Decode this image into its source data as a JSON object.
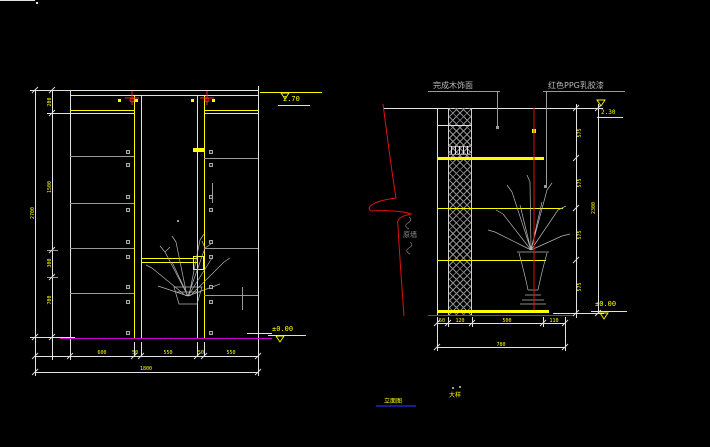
{
  "colors": {
    "line_yellow": "#ffff00",
    "line_white": "#e2e2e2",
    "line_gray": "#9a9a9a",
    "line_red": "#ff1a1a",
    "floor_magenta": "#cc00cc",
    "underline_navy": "#1b1b8f"
  },
  "left_view": {
    "elev_top": "2.70",
    "elev_floor": "±0.00",
    "vdim_segments": [
      "200",
      "1500",
      "300",
      "700"
    ],
    "vdim_total": "2700",
    "hdim_segments": [
      "600",
      "50",
      "550",
      "50",
      "550"
    ],
    "hdim_total": "1800"
  },
  "right_view": {
    "label_finish_wood": "完成木饰面",
    "label_red_ppg": "红色PPG乳胶漆",
    "label_wall": "原墙",
    "elev_top": "2.30",
    "elev_floor": "±0.00",
    "vdim_segments": [
      "575",
      "575",
      "575",
      "575"
    ],
    "vdim_total": "2300",
    "hdim_segments": [
      "50",
      "120",
      "500",
      "110"
    ],
    "hdim_total": "780"
  },
  "footer": {
    "title": "立面图",
    "scale": "大样"
  }
}
